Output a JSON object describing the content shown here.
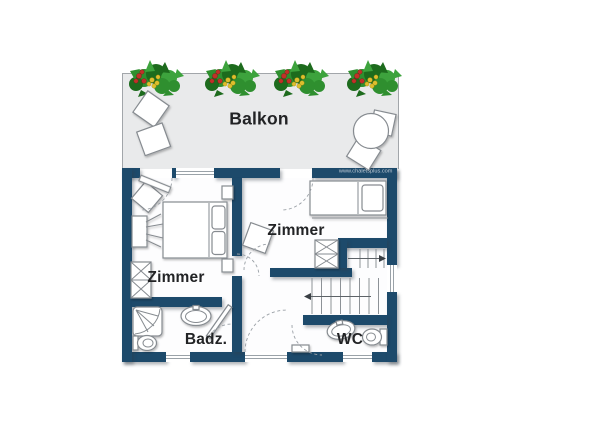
{
  "plan": {
    "watermark": "www.chaletsplus.com",
    "labels": {
      "balcony": "Balkon",
      "bedroom_left": "Zimmer",
      "bedroom_middle": "Zimmer",
      "bathroom": "Badz.",
      "wc": "WC"
    },
    "rooms": [
      "Balkon",
      "Zimmer",
      "Zimmer",
      "Badz.",
      "WC"
    ]
  },
  "colors": {
    "wall": "#1d4a6b",
    "balcony_floor": "#e9eaeb",
    "furniture_outline": "#868b90",
    "plant_green": "#2f8f2f",
    "plant_green_dark": "#1d6b1d",
    "plant_green_light": "#3da33d",
    "berry_red": "#c23028",
    "berry_yellow": "#ddbe2e"
  }
}
